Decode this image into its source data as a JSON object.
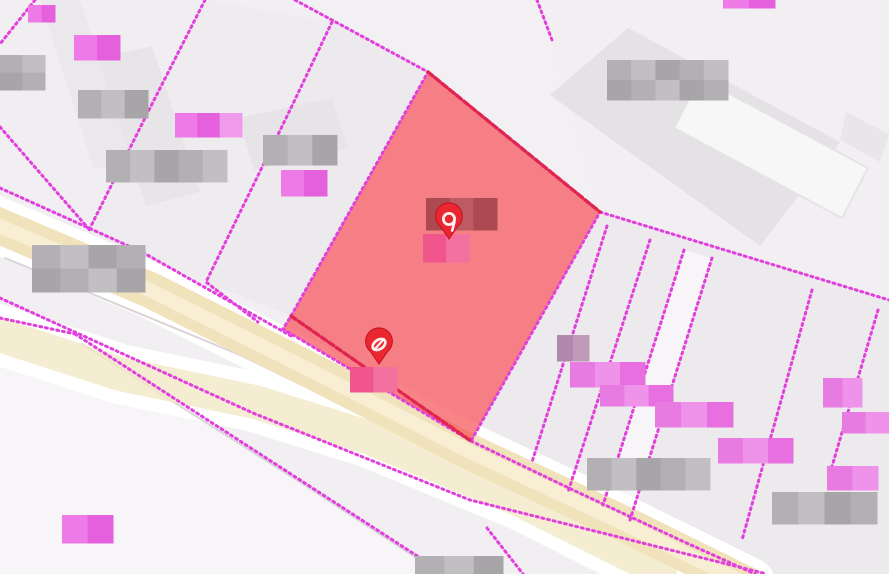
{
  "map": {
    "background": "#f2eff2",
    "palette": {
      "boundary_magenta": "#e23fdd",
      "boundary_crimson": "#e02550",
      "selected_parcel_fill": "#f64950",
      "selected_parcel_opacity": 0.68,
      "road_fill": "#f0e3bc",
      "road_fill_pale": "#f3e8c6",
      "road_center": "#f7eed5",
      "road_casing": "#ffffff",
      "gray_edge": "#d8d4d8",
      "pin_fill": "#e82730",
      "pin_stroke": "#c2101e",
      "pin_glyph": "#ffffff"
    },
    "label_palettes": {
      "gray": [
        "#b3b0b3",
        "#c2bfc2",
        "#a8a5a8"
      ],
      "pink": [
        "#e77be1",
        "#ef93ea",
        "#e76fe0"
      ],
      "brightpink": [
        "#ee7ae8",
        "#e560dc",
        "#f09aec"
      ],
      "hotpink": [
        "#f0568c",
        "#f2719f"
      ],
      "darkred": [
        "#ad4950",
        "#bd5b62"
      ],
      "purplegray": [
        "#b289ae",
        "#c09ab8"
      ]
    },
    "parcels": [
      {
        "name": "parcel-upper-left",
        "pts": "35,0 205,0 150,108 88,232 0,127 0,44",
        "fill": "#f0edf0",
        "op": 0.6
      },
      {
        "name": "parcel-left-band",
        "pts": "205,0 332,22 290,110 206,282 88,232 150,108",
        "fill": "#eeebee",
        "op": 0.8
      },
      {
        "name": "parcel-mid-band",
        "pts": "332,22 428,72 291,316 206,282 290,110",
        "fill": "#ebe8ec",
        "op": 0.75
      },
      {
        "name": "parcel-top-middle",
        "pts": "295,0 540,0 600,212 428,72",
        "fill": "#f3f0f3",
        "op": 0.8
      },
      {
        "name": "parcel-right-strip",
        "pts": "600,212 889,302 889,574 755,574 468,440",
        "fill": "#e9e6ea",
        "op": 0.65
      },
      {
        "name": "parcel-right-white",
        "pts": "684,250 712,258 630,520 603,505",
        "fill": "#f7f5f7",
        "op": 1
      },
      {
        "name": "parcel-lower-left",
        "pts": "0,318 75,334 445,574 0,574",
        "fill": "#f7f5f8",
        "op": 1
      }
    ],
    "buildings": [
      {
        "name": "building-left-1",
        "pts": "40,0 80,0 132,158 94,170",
        "fill": "#ebe8eb"
      },
      {
        "name": "building-left-2",
        "pts": "98,58 152,46 200,192 146,206",
        "fill": "#e8e5e8"
      },
      {
        "name": "building-mid",
        "pts": "238,118 332,98 348,148 254,170",
        "fill": "#e7e4e7"
      },
      {
        "name": "building-top-right-large",
        "pts": "550,95 628,28 840,142 760,246",
        "fill": "#e4e2e5"
      },
      {
        "name": "building-top-right-white",
        "pts": "700,78 868,168 842,218 674,128",
        "fill": "#f8f7f8",
        "stroke": "#e5e3e6"
      },
      {
        "name": "building-right-edge",
        "pts": "846,112 889,134 880,162 840,140",
        "fill": "#e8e6e9"
      }
    ],
    "roads": [
      {
        "name": "road-lower-lane",
        "d": "M -10 332 L 120 374 L 255 402 L 370 438 L 520 500 L 660 570",
        "casing_w": 60,
        "fill": "#f3e8c6",
        "fill_w": 34,
        "op": 0.8
      },
      {
        "name": "road-main",
        "d": "M -10 222 L 150 290 L 300 365 L 470 452 L 620 522 L 748 585",
        "casing_w": 56,
        "fill": "#f0e3bc",
        "fill_w": 36,
        "op": 1,
        "center": "#f7eed5",
        "center_w": 14
      }
    ],
    "gray_edges": [
      {
        "name": "road-edge-upper",
        "d": "M 5 258 L 240 355 L 460 462"
      },
      {
        "name": "road-edge-lower",
        "d": "M 82 344 L 300 482 L 432 568"
      }
    ],
    "boundary_lines": [
      {
        "name": "boundary-top-left-corner",
        "pts": "35,0 0,44",
        "style": "magenta"
      },
      {
        "name": "boundary-left-a",
        "pts": "205,0 150,108 88,232",
        "style": "magenta"
      },
      {
        "name": "boundary-left-b",
        "pts": "332,22 290,110 206,282 258,322",
        "style": "magenta"
      },
      {
        "name": "boundary-left-edge",
        "pts": "0,127 88,228",
        "style": "magenta"
      },
      {
        "name": "boundary-to-apex",
        "pts": "295,0 428,72",
        "style": "magenta"
      },
      {
        "name": "boundary-top-mid-stub",
        "pts": "537,0 552,40",
        "style": "magenta"
      },
      {
        "name": "boundary-road-upper",
        "pts": "0,188 142,252 293,337",
        "style": "magenta"
      },
      {
        "name": "boundary-road-upper-right",
        "pts": "471,441 573,490 680,540 755,574",
        "style": "magenta"
      },
      {
        "name": "boundary-road-median",
        "pts": "0,298 253,413 470,500 767,574",
        "style": "magenta"
      },
      {
        "name": "boundary-lowerleft-a",
        "pts": "0,318 75,334",
        "style": "magenta"
      },
      {
        "name": "boundary-lowerleft-b",
        "pts": "75,334 445,574",
        "style": "magenta"
      },
      {
        "name": "boundary-right-long",
        "pts": "600,212 889,300",
        "style": "magenta"
      },
      {
        "name": "boundary-right-q1",
        "pts": "607,226 532,462",
        "style": "magenta"
      },
      {
        "name": "boundary-right-q2",
        "pts": "650,240 568,492",
        "style": "magenta"
      },
      {
        "name": "boundary-right-q3",
        "pts": "684,250 603,505",
        "style": "magenta"
      },
      {
        "name": "boundary-right-q4",
        "pts": "712,258 630,520",
        "style": "magenta"
      },
      {
        "name": "boundary-right-q5",
        "pts": "812,290 742,540",
        "style": "magenta"
      },
      {
        "name": "boundary-right-q6",
        "pts": "878,310 828,480",
        "style": "magenta"
      },
      {
        "name": "boundary-road-crossing",
        "pts": "487,528 523,574",
        "style": "magenta"
      }
    ],
    "selected_parcel": {
      "name": "selected-parcel",
      "pts": "428,72 600,212 471,441 283,329 291,316",
      "outline_style": "magenta",
      "emphasis_edges": [
        {
          "name": "selected-parcel-upper-edge",
          "pts": "428,72 600,212"
        },
        {
          "name": "selected-parcel-split-line",
          "pts": "291,316 471,441"
        }
      ]
    },
    "labels": [
      {
        "name": "blurred-label-tl-tiny",
        "x": 28,
        "y": 5,
        "w": 27,
        "h": 17,
        "tone": "brightpink"
      },
      {
        "name": "blurred-label-tl-gray",
        "x": 0,
        "y": 55,
        "w": 45,
        "h": 35,
        "tone": "gray"
      },
      {
        "name": "blurred-label-tl-gray2",
        "x": 78,
        "y": 90,
        "w": 70,
        "h": 28,
        "tone": "gray"
      },
      {
        "name": "blurred-label-tl-pink",
        "x": 74,
        "y": 35,
        "w": 46,
        "h": 25,
        "tone": "brightpink"
      },
      {
        "name": "blurred-label-mid-pink",
        "x": 175,
        "y": 113,
        "w": 67,
        "h": 24,
        "tone": "brightpink"
      },
      {
        "name": "blurred-label-mid-gray",
        "x": 106,
        "y": 150,
        "w": 121,
        "h": 32,
        "tone": "gray"
      },
      {
        "name": "blurred-label-mid-gray2",
        "x": 263,
        "y": 135,
        "w": 74,
        "h": 30,
        "tone": "gray"
      },
      {
        "name": "blurred-label-mid-pink2",
        "x": 281,
        "y": 170,
        "w": 46,
        "h": 26,
        "tone": "brightpink"
      },
      {
        "name": "blurred-label-road-left",
        "x": 32,
        "y": 245,
        "w": 113,
        "h": 47,
        "tone": "gray"
      },
      {
        "name": "blurred-label-tr-gray",
        "x": 607,
        "y": 60,
        "w": 121,
        "h": 40,
        "tone": "gray"
      },
      {
        "name": "blurred-label-tr-tiny",
        "x": 723,
        "y": 0,
        "w": 52,
        "h": 8,
        "tone": "brightpink"
      },
      {
        "name": "blurred-label-pin1-dark",
        "x": 426,
        "y": 198,
        "w": 71,
        "h": 32,
        "tone": "darkred"
      },
      {
        "name": "blurred-label-pin1-pink",
        "x": 423,
        "y": 234,
        "w": 46,
        "h": 28,
        "tone": "hotpink"
      },
      {
        "name": "blurred-label-pin2-pink",
        "x": 350,
        "y": 367,
        "w": 47,
        "h": 25,
        "tone": "hotpink"
      },
      {
        "name": "blurred-label-stair-0",
        "x": 557,
        "y": 335,
        "w": 32,
        "h": 26,
        "tone": "purplegray"
      },
      {
        "name": "blurred-label-stair-1",
        "x": 570,
        "y": 362,
        "w": 75,
        "h": 25,
        "tone": "pink"
      },
      {
        "name": "blurred-label-stair-2",
        "x": 600,
        "y": 385,
        "w": 73,
        "h": 21,
        "tone": "pink"
      },
      {
        "name": "blurred-label-stair-3",
        "x": 655,
        "y": 402,
        "w": 78,
        "h": 25,
        "tone": "pink"
      },
      {
        "name": "blurred-label-right-1",
        "x": 823,
        "y": 378,
        "w": 39,
        "h": 29,
        "tone": "pink"
      },
      {
        "name": "blurred-label-right-2",
        "x": 842,
        "y": 412,
        "w": 47,
        "h": 21,
        "tone": "pink"
      },
      {
        "name": "blurred-label-br-pink1",
        "x": 718,
        "y": 438,
        "w": 75,
        "h": 25,
        "tone": "pink"
      },
      {
        "name": "blurred-label-br-pink2",
        "x": 827,
        "y": 466,
        "w": 51,
        "h": 24,
        "tone": "pink"
      },
      {
        "name": "blurred-label-br-gray1",
        "x": 587,
        "y": 458,
        "w": 123,
        "h": 32,
        "tone": "gray"
      },
      {
        "name": "blurred-label-br-gray2",
        "x": 772,
        "y": 492,
        "w": 105,
        "h": 32,
        "tone": "gray"
      },
      {
        "name": "blurred-label-bottom",
        "x": 415,
        "y": 556,
        "w": 88,
        "h": 18,
        "tone": "gray"
      },
      {
        "name": "blurred-label-bl-pink",
        "x": 62,
        "y": 515,
        "w": 51,
        "h": 28,
        "tone": "brightpink"
      }
    ],
    "markers": [
      {
        "name": "map-pin-upper",
        "tip_x": 449,
        "tip_y": 239,
        "glyph": "ring-tail-icon"
      },
      {
        "name": "map-pin-lower",
        "tip_x": 379,
        "tip_y": 364,
        "glyph": "slashed-oval-icon"
      }
    ]
  }
}
